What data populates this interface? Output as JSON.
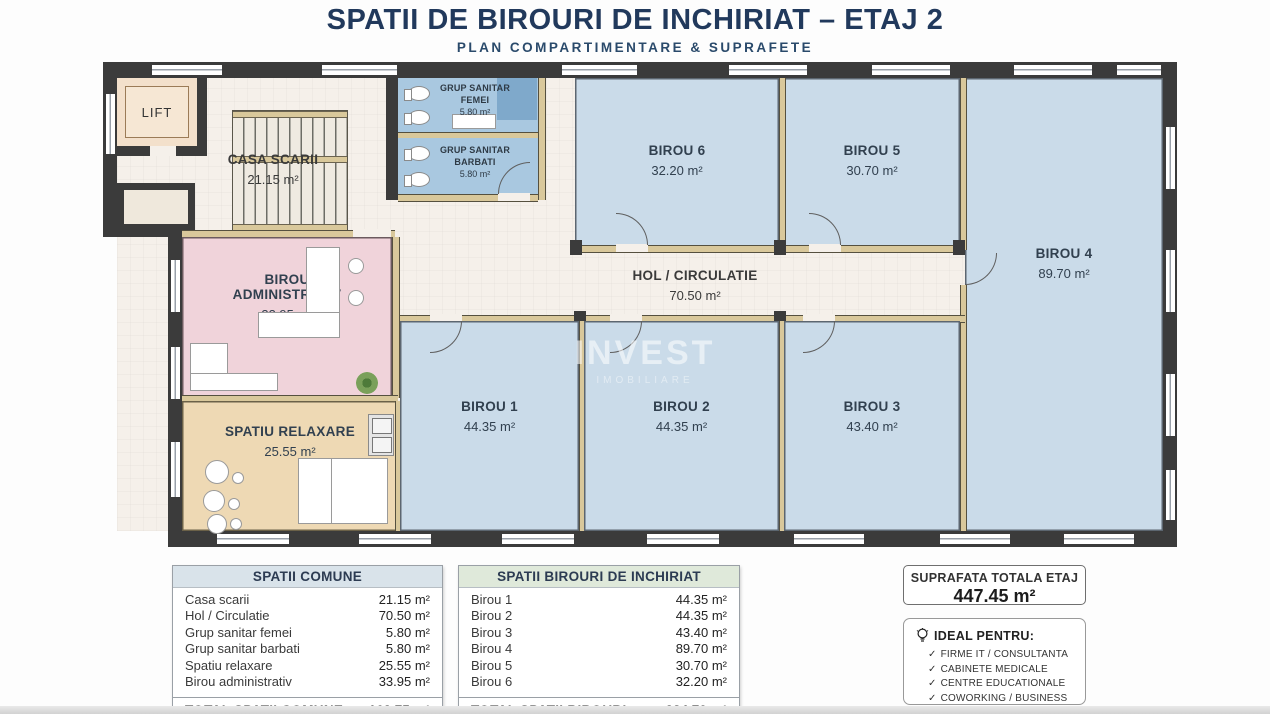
{
  "title": "SPATII DE BIROURI DE INCHIRIAT – ETAJ 2",
  "subtitle": "PLAN COMPARTIMENTARE & SUPRAFETE",
  "watermark": {
    "line1": "INVEST",
    "line2": "IMOBILIARE"
  },
  "rooms": {
    "lift": {
      "name": "LIFT"
    },
    "casa_scarii": {
      "name": "CASA SCARII",
      "area": "21.15 m²"
    },
    "gs_femei": {
      "line1": "GRUP SANITAR",
      "line2": "FEMEI",
      "area": "5.80 m²"
    },
    "gs_barbati": {
      "line1": "GRUP SANITAR",
      "line2": "BARBATI",
      "area": "5.80 m²"
    },
    "birou1": {
      "name": "BIROU 1",
      "area": "44.35 m²"
    },
    "birou2": {
      "name": "BIROU 2",
      "area": "44.35 m²"
    },
    "birou3": {
      "name": "BIROU 3",
      "area": "43.40 m²"
    },
    "birou4": {
      "name": "BIROU 4",
      "area": "89.70 m²"
    },
    "birou5": {
      "name": "BIROU 5",
      "area": "30.70 m²"
    },
    "birou6": {
      "name": "BIROU 6",
      "area": "32.20 m²"
    },
    "hol": {
      "name": "HOL / CIRCULATIE",
      "area": "70.50 m²"
    },
    "birou_administrativ": {
      "line1": "BIROU",
      "line2": "ADMINISTRATIV",
      "area": "33.95 m²"
    },
    "spatiu_relaxare": {
      "name": "SPATIU RELAXARE",
      "area": "25.55 m²"
    }
  },
  "tables": {
    "comune": {
      "header": "SPATII COMUNE",
      "rows": [
        [
          "Casa scarii",
          "21.15 m²"
        ],
        [
          "Hol / Circulatie",
          "70.50 m²"
        ],
        [
          "Grup sanitar femei",
          "5.80 m²"
        ],
        [
          "Grup sanitar barbati",
          "5.80 m²"
        ],
        [
          "Spatiu relaxare",
          "25.55 m²"
        ],
        [
          "Birou administrativ",
          "33.95 m²"
        ]
      ],
      "total_label": "TOTAL SPATII COMUNE",
      "total_value": "162.75 m²"
    },
    "birouri": {
      "header": "SPATII BIROURI DE INCHIRIAT",
      "rows": [
        [
          "Birou 1",
          "44.35 m²"
        ],
        [
          "Birou 2",
          "44.35 m²"
        ],
        [
          "Birou 3",
          "43.40 m²"
        ],
        [
          "Birou 4",
          "89.70 m²"
        ],
        [
          "Birou 5",
          "30.70 m²"
        ],
        [
          "Birou 6",
          "32.20 m²"
        ]
      ],
      "total_label": "TOTAL SPATII BIROURI",
      "total_value": "284.70 m²"
    }
  },
  "summary": {
    "title": "SUPRAFATA TOTALA ETAJ",
    "value": "447.45 m²"
  },
  "ideal": {
    "title": "IDEAL PENTRU:",
    "check": "✓",
    "items": [
      "FIRME IT / CONSULTANTA",
      "CABINETE MEDICALE",
      "CENTRE EDUCATIONALE",
      "COWORKING / BUSINESS HUB"
    ]
  },
  "colors": {
    "title_navy": "#21395c",
    "wall_dark": "#3b3b3b",
    "office_blue": "#cadbe9",
    "bathroom_blue": "#a9c8e0",
    "admin_pink": "#f0d3da",
    "relax_tan": "#eed9b4",
    "corridor_cream": "#f5f0ea",
    "comune_header_bg": "#d9e3ea",
    "birouri_header_bg": "#dfe9da"
  }
}
